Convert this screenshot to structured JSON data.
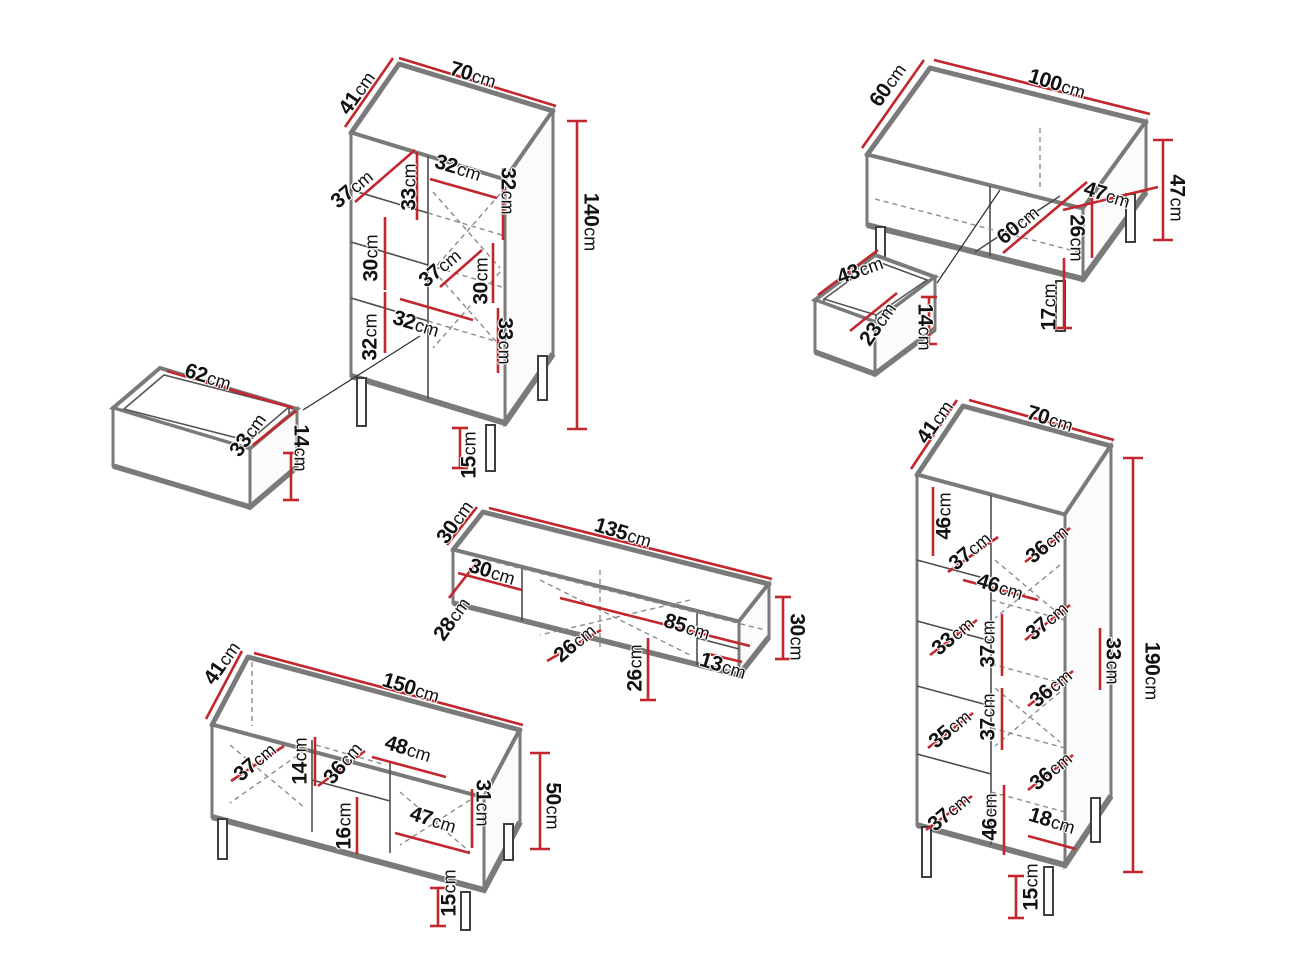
{
  "diagram": {
    "unit": "cm",
    "colors": {
      "dimension_line": "#c1272d",
      "outline": "#7a7a7a",
      "hidden_line": "#8c8c8c",
      "label_text": "#111111",
      "background": "#ffffff"
    }
  },
  "furniture": [
    {
      "id": "display-cabinet",
      "name": "Display cabinet",
      "overall": {
        "width": "70cm",
        "depth": "41cm",
        "height": "140cm"
      },
      "labels": [
        {
          "text": "41cm",
          "x": 357,
          "y": 93,
          "rot": -55
        },
        {
          "text": "70cm",
          "x": 473,
          "y": 75,
          "rot": 17
        },
        {
          "text": "140cm",
          "x": 591,
          "y": 222,
          "rot": 90
        },
        {
          "text": "37cm",
          "x": 352,
          "y": 189,
          "rot": -40
        },
        {
          "text": "33cm",
          "x": 409,
          "y": 187,
          "rot": -90
        },
        {
          "text": "32cm",
          "x": 458,
          "y": 168,
          "rot": 17
        },
        {
          "text": "32cm",
          "x": 508,
          "y": 191,
          "rot": 90
        },
        {
          "text": "30cm",
          "x": 371,
          "y": 258,
          "rot": -90
        },
        {
          "text": "37cm",
          "x": 440,
          "y": 268,
          "rot": -40
        },
        {
          "text": "30cm",
          "x": 481,
          "y": 281,
          "rot": -90
        },
        {
          "text": "32cm",
          "x": 370,
          "y": 337,
          "rot": -90
        },
        {
          "text": "32cm",
          "x": 416,
          "y": 324,
          "rot": 17
        },
        {
          "text": "33cm",
          "x": 505,
          "y": 341,
          "rot": 90
        },
        {
          "text": "15cm",
          "x": 469,
          "y": 455,
          "rot": -90
        }
      ]
    },
    {
      "id": "drawer-62",
      "name": "Drawer",
      "overall": {
        "width": "62cm",
        "depth": "33cm",
        "height": "14cm"
      },
      "labels": [
        {
          "text": "62cm",
          "x": 208,
          "y": 377,
          "rot": 17
        },
        {
          "text": "33cm",
          "x": 248,
          "y": 435,
          "rot": -55
        },
        {
          "text": "14cm",
          "x": 301,
          "y": 448,
          "rot": 90
        }
      ]
    },
    {
      "id": "coffee-table",
      "name": "Coffee table",
      "overall": {
        "width": "100cm",
        "depth": "60cm",
        "height": "47cm"
      },
      "labels": [
        {
          "text": "60cm",
          "x": 888,
          "y": 85,
          "rot": -55
        },
        {
          "text": "100cm",
          "x": 1057,
          "y": 84,
          "rot": 17
        },
        {
          "text": "47cm",
          "x": 1177,
          "y": 198,
          "rot": 90
        },
        {
          "text": "47cm",
          "x": 1107,
          "y": 195,
          "rot": 17
        },
        {
          "text": "60cm",
          "x": 1018,
          "y": 225,
          "rot": -40
        },
        {
          "text": "26cm",
          "x": 1077,
          "y": 238,
          "rot": 90
        },
        {
          "text": "17cm",
          "x": 1049,
          "y": 307,
          "rot": -90
        }
      ]
    },
    {
      "id": "drawer-43",
      "name": "Drawer",
      "overall": {
        "width": "43cm",
        "depth": "23cm",
        "height": "14cm"
      },
      "labels": [
        {
          "text": "43cm",
          "x": 860,
          "y": 270,
          "rot": -20
        },
        {
          "text": "23cm",
          "x": 878,
          "y": 324,
          "rot": -55
        },
        {
          "text": "14cm",
          "x": 925,
          "y": 327,
          "rot": 90
        }
      ]
    },
    {
      "id": "wall-shelf",
      "name": "Wall shelf",
      "overall": {
        "width": "135cm",
        "depth": "30cm",
        "height": "30cm"
      },
      "labels": [
        {
          "text": "30cm",
          "x": 455,
          "y": 522,
          "rot": -55
        },
        {
          "text": "135cm",
          "x": 623,
          "y": 533,
          "rot": 17
        },
        {
          "text": "30cm",
          "x": 492,
          "y": 572,
          "rot": 17
        },
        {
          "text": "28cm",
          "x": 452,
          "y": 619,
          "rot": -55
        },
        {
          "text": "26cm",
          "x": 575,
          "y": 643,
          "rot": -40
        },
        {
          "text": "26cm",
          "x": 635,
          "y": 668,
          "rot": -90
        },
        {
          "text": "85cm",
          "x": 687,
          "y": 627,
          "rot": 17
        },
        {
          "text": "13cm",
          "x": 723,
          "y": 666,
          "rot": 17
        },
        {
          "text": "30cm",
          "x": 797,
          "y": 637,
          "rot": 90
        }
      ]
    },
    {
      "id": "tv-stand",
      "name": "TV stand",
      "overall": {
        "width": "150cm",
        "depth": "41cm",
        "height": "50cm"
      },
      "labels": [
        {
          "text": "41cm",
          "x": 222,
          "y": 663,
          "rot": -55
        },
        {
          "text": "150cm",
          "x": 411,
          "y": 688,
          "rot": 17
        },
        {
          "text": "37cm",
          "x": 255,
          "y": 762,
          "rot": -40
        },
        {
          "text": "14cm",
          "x": 300,
          "y": 761,
          "rot": -90
        },
        {
          "text": "36cm",
          "x": 343,
          "y": 763,
          "rot": -50
        },
        {
          "text": "48cm",
          "x": 408,
          "y": 749,
          "rot": 17
        },
        {
          "text": "16cm",
          "x": 344,
          "y": 826,
          "rot": -90
        },
        {
          "text": "47cm",
          "x": 433,
          "y": 820,
          "rot": 17
        },
        {
          "text": "31cm",
          "x": 483,
          "y": 803,
          "rot": 90
        },
        {
          "text": "50cm",
          "x": 553,
          "y": 806,
          "rot": 90
        },
        {
          "text": "15cm",
          "x": 449,
          "y": 893,
          "rot": -90
        }
      ]
    },
    {
      "id": "bookcase",
      "name": "Bookcase",
      "overall": {
        "width": "70cm",
        "depth": "41cm",
        "height": "190cm"
      },
      "labels": [
        {
          "text": "41cm",
          "x": 935,
          "y": 422,
          "rot": -55
        },
        {
          "text": "70cm",
          "x": 1050,
          "y": 419,
          "rot": 17
        },
        {
          "text": "190cm",
          "x": 1152,
          "y": 671,
          "rot": 90
        },
        {
          "text": "46cm",
          "x": 944,
          "y": 516,
          "rot": -90
        },
        {
          "text": "37cm",
          "x": 970,
          "y": 551,
          "rot": -40
        },
        {
          "text": "46cm",
          "x": 1000,
          "y": 587,
          "rot": 17
        },
        {
          "text": "36cm",
          "x": 1047,
          "y": 544,
          "rot": -40
        },
        {
          "text": "33cm",
          "x": 953,
          "y": 636,
          "rot": -40
        },
        {
          "text": "37cm",
          "x": 988,
          "y": 644,
          "rot": -90
        },
        {
          "text": "37cm",
          "x": 1047,
          "y": 621,
          "rot": -40
        },
        {
          "text": "33cm",
          "x": 1113,
          "y": 661,
          "rot": 90
        },
        {
          "text": "35cm",
          "x": 950,
          "y": 729,
          "rot": -40
        },
        {
          "text": "37cm",
          "x": 988,
          "y": 717,
          "rot": -90
        },
        {
          "text": "36cm",
          "x": 1051,
          "y": 688,
          "rot": -40
        },
        {
          "text": "36cm",
          "x": 1051,
          "y": 771,
          "rot": -40
        },
        {
          "text": "37cm",
          "x": 949,
          "y": 812,
          "rot": -40
        },
        {
          "text": "46cm",
          "x": 990,
          "y": 817,
          "rot": -90
        },
        {
          "text": "18cm",
          "x": 1052,
          "y": 821,
          "rot": 17
        },
        {
          "text": "15cm",
          "x": 1031,
          "y": 887,
          "rot": -90
        }
      ]
    }
  ]
}
